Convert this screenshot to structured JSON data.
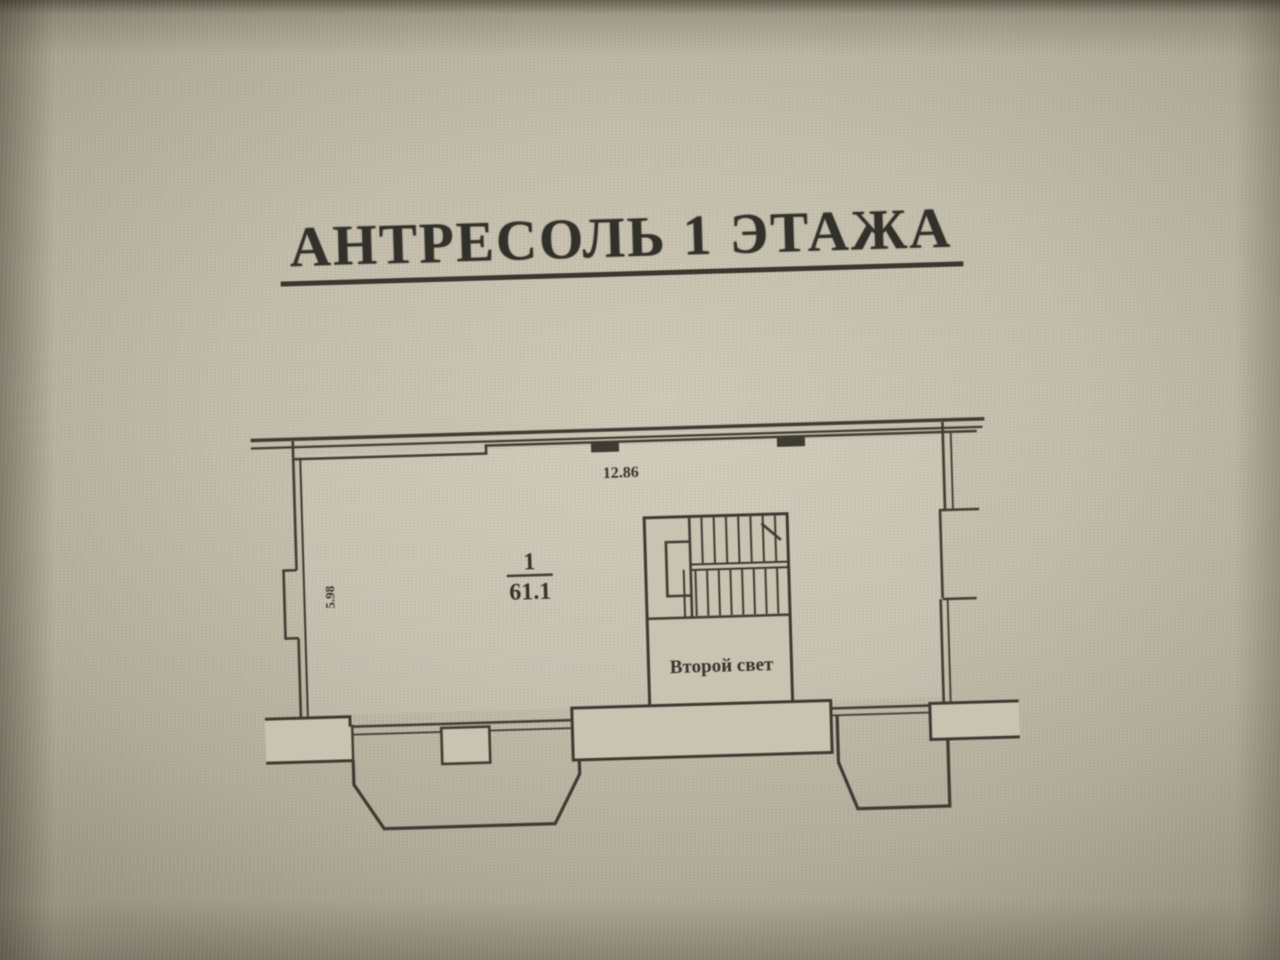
{
  "title": {
    "text": "АНТРЕСОЛЬ 1 ЭТАЖА"
  },
  "plan": {
    "top_dimension": "12.86",
    "side_dimension": "5.98",
    "room": {
      "number": "1",
      "area": "61.1"
    },
    "void_label": "Второй свет",
    "stairs": {
      "flights": 2,
      "upper_treads": 8,
      "lower_treads": 9
    }
  },
  "colors": {
    "paper": "#c3bdab",
    "paper_light": "#c9c3b1",
    "line": "#3e3b33",
    "text": "#32302a"
  }
}
